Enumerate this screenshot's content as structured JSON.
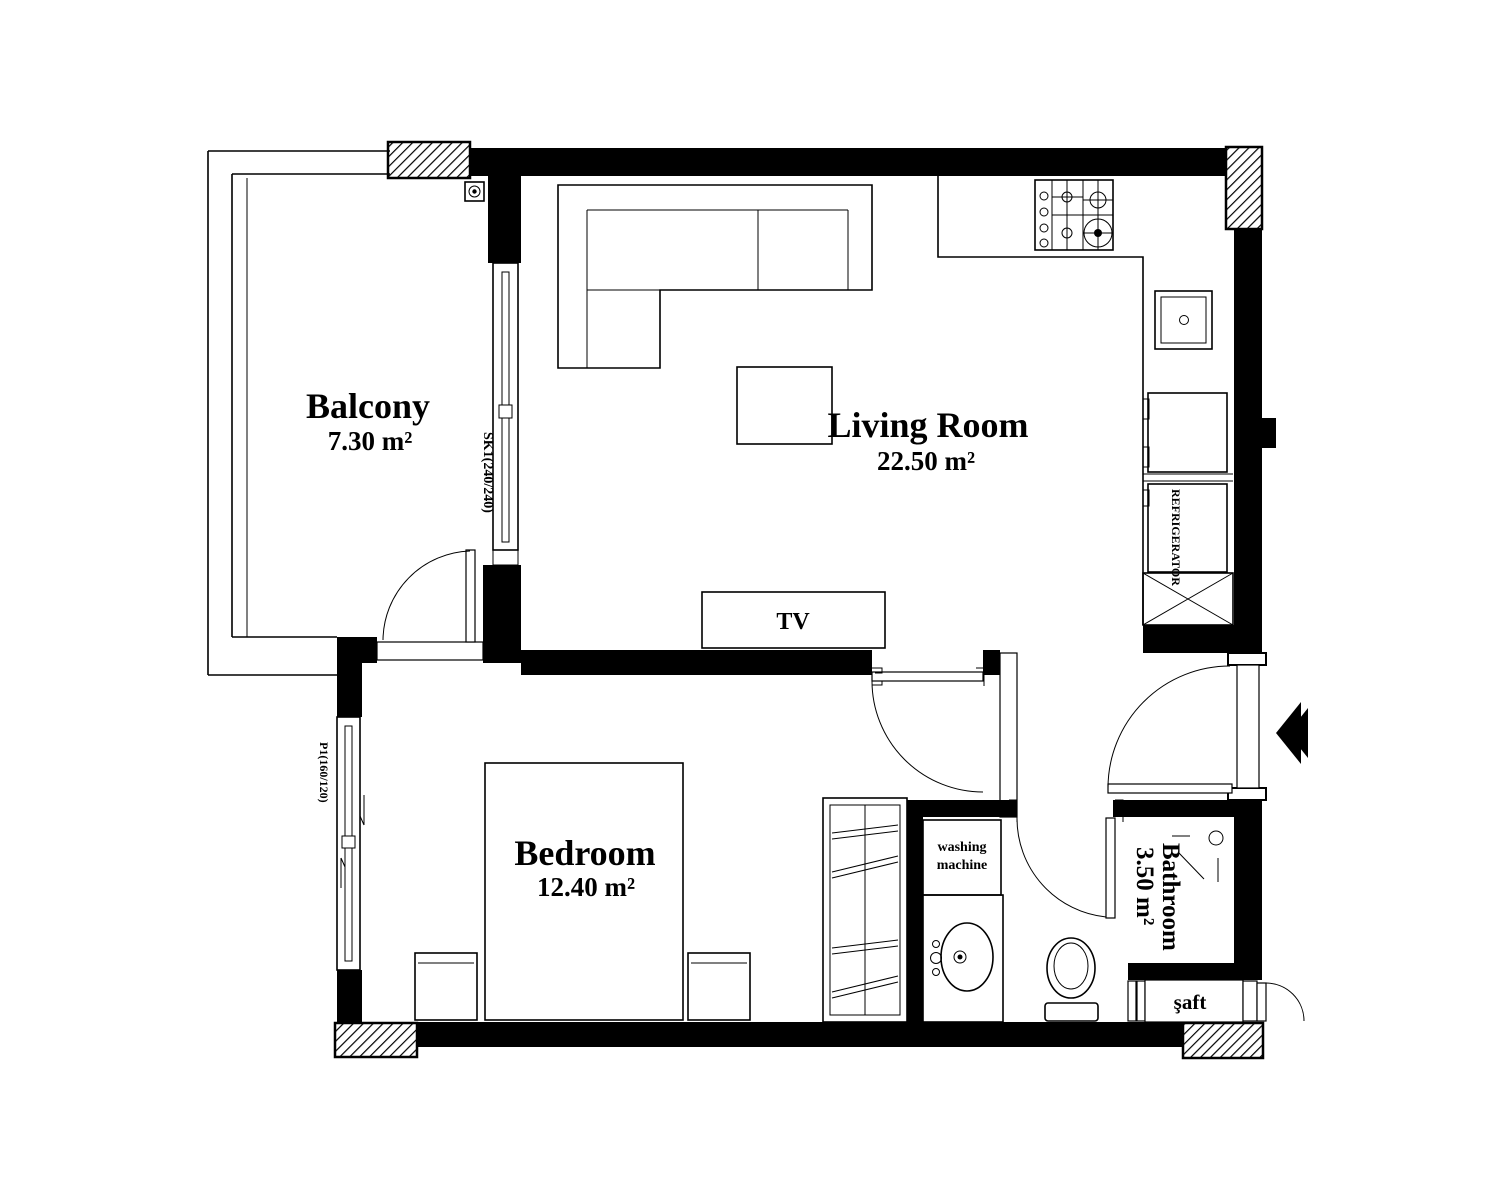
{
  "plan": {
    "title": "Apartment Floor Plan",
    "colors": {
      "ink": "#000000",
      "background": "#ffffff"
    }
  },
  "rooms": {
    "balcony": {
      "name": "Balcony",
      "area": "7.30 m²"
    },
    "living_room": {
      "name": "Living Room",
      "area": "22.50 m²"
    },
    "bedroom": {
      "name": "Bedroom",
      "area": "12.40 m²"
    },
    "bathroom": {
      "name": "Bathroom",
      "area": "3.50 m²"
    }
  },
  "labels": {
    "tv": "TV",
    "refrigerator": "REFRIGERATOR",
    "washing_machine_line1": "washing",
    "washing_machine_line2": "machine",
    "shaft": "şaft",
    "balcony_door_code": "SK1(240/240)",
    "bedroom_window_code": "P1(160/120)"
  }
}
